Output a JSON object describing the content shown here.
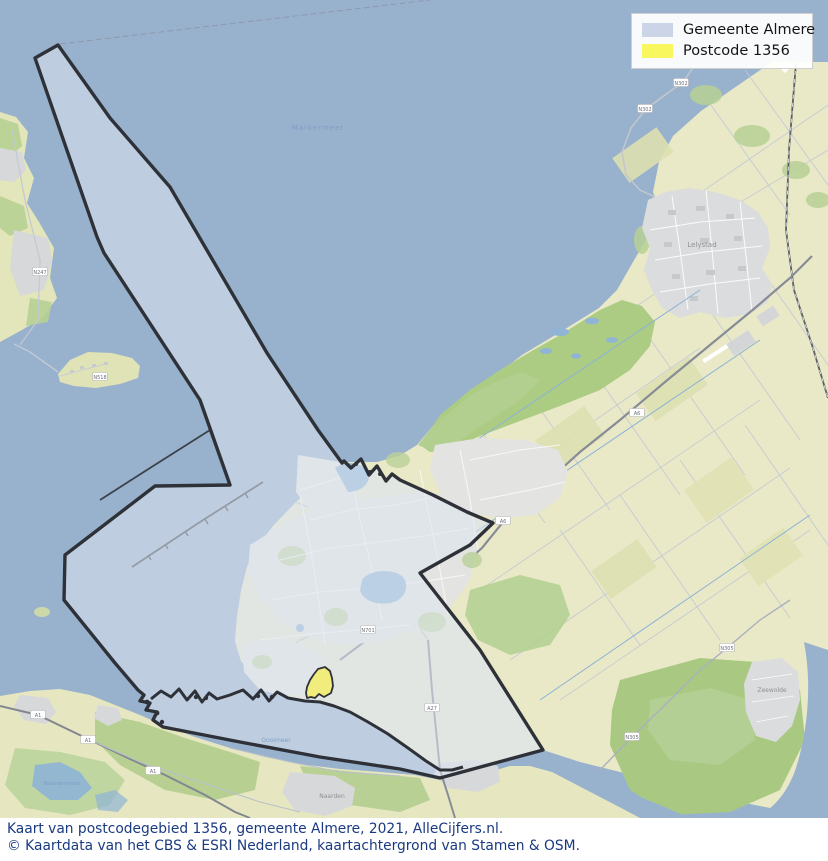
{
  "legend": {
    "items": [
      {
        "label": "Gemeente Almere",
        "color": "#ccd4e8"
      },
      {
        "label": "Postcode 1356",
        "color": "#f8f85e"
      }
    ]
  },
  "caption": {
    "line1": "Kaart van postcodegebied 1356, gemeente Almere, 2021, AlleCijfers.nl.",
    "line2": "© Kaartdata van het CBS & ESRI Nederland, kaartachtergrond van Stamen & OSM."
  },
  "map": {
    "colors": {
      "water": "#98b2cd",
      "land": "#e9e9c7",
      "green": "#b2cf90",
      "urban": "#dbdcdd",
      "municipality_fill": "rgba(223,229,241,0.55)",
      "municipality_stroke": "#2e3238",
      "postcode_fill": "#f0ed7c"
    },
    "regions": [
      {
        "name": "Gemeente Almere"
      },
      {
        "name": "Postcode 1356"
      }
    ],
    "water_labels": [
      {
        "text": "Markermeer"
      },
      {
        "text": "Gooimeer"
      },
      {
        "text": "Naardermeer"
      }
    ],
    "place_labels": [
      {
        "text": "Lelystad"
      },
      {
        "text": "Naarden"
      },
      {
        "text": "Zeewolde"
      }
    ],
    "road_shields": [
      {
        "label": "N247"
      },
      {
        "label": "N518"
      },
      {
        "label": "N302"
      },
      {
        "label": "N302"
      },
      {
        "label": "A6"
      },
      {
        "label": "A6"
      },
      {
        "label": "A27"
      },
      {
        "label": "A1"
      },
      {
        "label": "A1"
      },
      {
        "label": "A1"
      },
      {
        "label": "N305"
      },
      {
        "label": "N305"
      },
      {
        "label": "N701"
      }
    ]
  }
}
